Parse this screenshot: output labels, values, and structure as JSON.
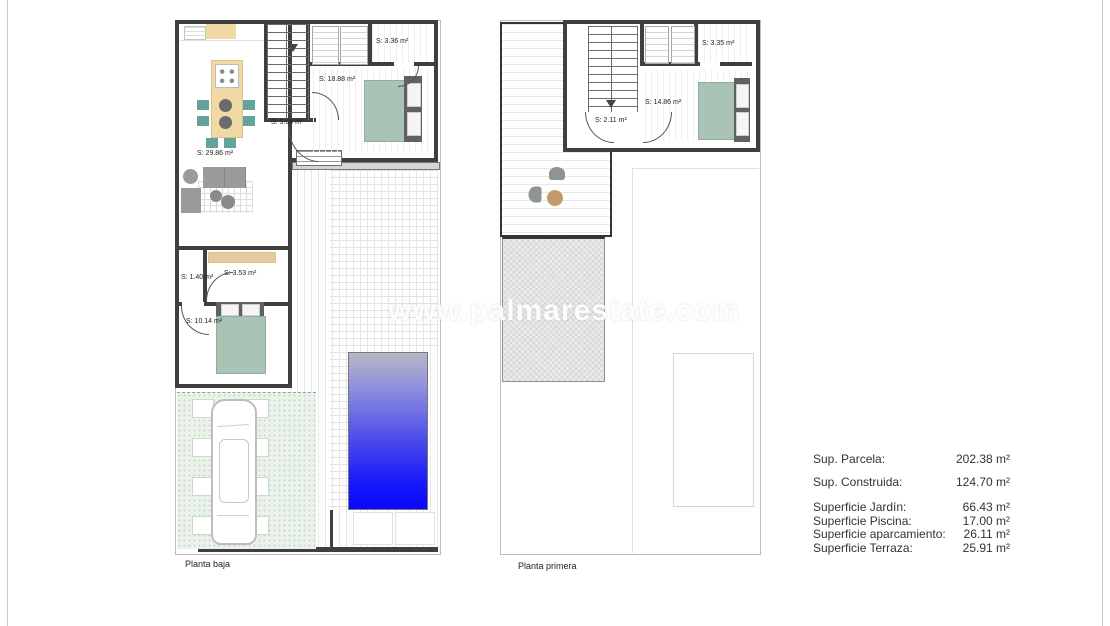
{
  "watermark": "www.palmarestate.com",
  "plans": {
    "ground": {
      "title": "Planta baja",
      "living": "S: 29.86 m²",
      "hall_upper": "S: 18.88 m²",
      "closet": "S: 3.36 m²",
      "hall": "S: 5.64 m²",
      "wc": "S: 1.40 m²",
      "bath": "S: 3.53 m²",
      "bedroom": "S: 10.14 m²"
    },
    "first": {
      "title": "Planta primera",
      "landing": "S: 2.11 m²",
      "bedroom": "S: 14.86 m²",
      "closet": "S: 3.35 m²"
    }
  },
  "areas": {
    "primary": [
      {
        "label": "Sup. Parcela:",
        "value": "202.38 m²"
      },
      {
        "label": "Sup. Construida:",
        "value": "124.70 m²"
      }
    ],
    "secondary": [
      {
        "label": "Superficie Jardín:",
        "value": "66.43 m²"
      },
      {
        "label": "Superficie Piscina:",
        "value": "17.00 m²"
      },
      {
        "label": "Superficie aparcamiento:",
        "value": "26.11 m²"
      },
      {
        "label": "Superficie Terraza:",
        "value": "25.91 m²"
      }
    ]
  },
  "colors": {
    "wall": "#3f3f3f",
    "bed_green": "#a9c3b4",
    "kitchen_beige": "#f0d9a4",
    "chair_teal": "#63a39b",
    "pool_blue": "#0808ff",
    "garden_green": "#eaf2ea",
    "furniture_gray": "#9b9b9b",
    "terrace_table_tan": "#c49a6c"
  }
}
